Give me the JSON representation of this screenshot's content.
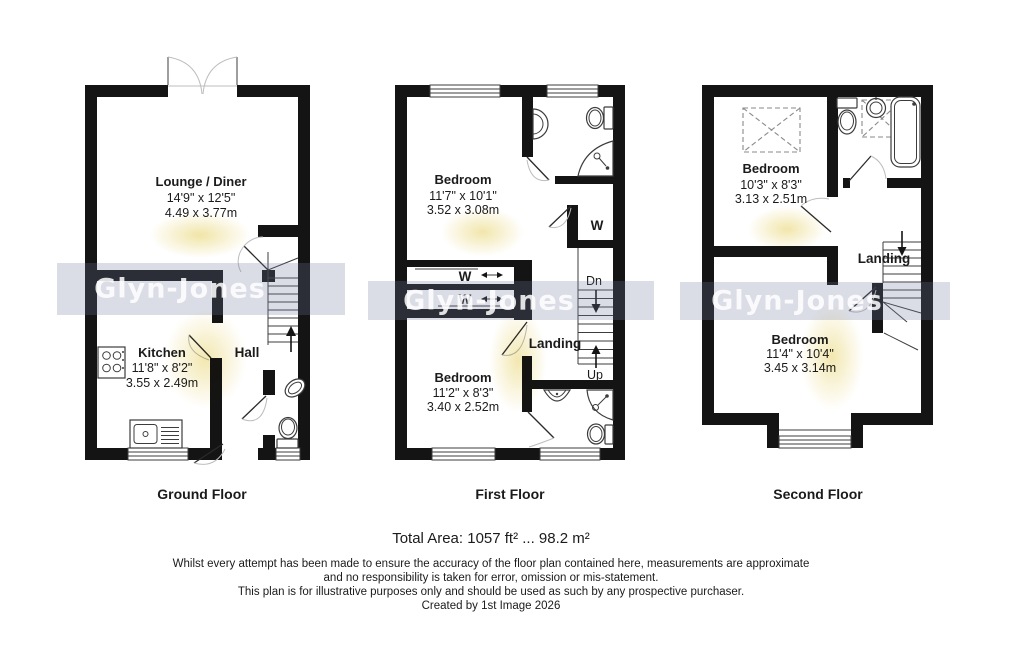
{
  "watermark": {
    "brand": "Glyn-Jones"
  },
  "floors": {
    "ground": {
      "title": "Ground Floor",
      "lounge": {
        "name": "Lounge / Diner",
        "imperial": "14'9\" x 12'5\"",
        "metric": "4.49 x 3.77m"
      },
      "kitchen": {
        "name": "Kitchen",
        "imperial": "11'8\" x 8'2\"",
        "metric": "3.55 x 2.49m"
      },
      "hall": {
        "name": "Hall"
      }
    },
    "first": {
      "title": "First Floor",
      "bedroom_front": {
        "name": "Bedroom",
        "imperial": "11'7\" x 10'1\"",
        "metric": "3.52 x 3.08m"
      },
      "bedroom_back": {
        "name": "Bedroom",
        "imperial": "11'2\" x 8'3\"",
        "metric": "3.40 x 2.52m"
      },
      "landing": {
        "name": "Landing"
      },
      "wardrobe_label": "W",
      "stairs_down_label": "Dn",
      "stairs_up_label": "Up"
    },
    "second": {
      "title": "Second Floor",
      "bedroom_front": {
        "name": "Bedroom",
        "imperial": "10'3\" x 8'3\"",
        "metric": "3.13 x 2.51m"
      },
      "bedroom_back": {
        "name": "Bedroom",
        "imperial": "11'4\" x 10'4\"",
        "metric": "3.45 x 3.14m"
      },
      "landing": {
        "name": "Landing"
      }
    }
  },
  "footer": {
    "total_area": "Total Area: 1057 ft² ... 98.2 m²",
    "disclaimer_line1": "Whilst every attempt has been made to ensure the accuracy of the floor plan contained here, measurements are approximate",
    "disclaimer_line2": "and no responsibility is taken for error, omission or mis-statement.",
    "disclaimer_line3": "This plan is for illustrative purposes only and should be used as such by any prospective purchaser.",
    "created_by": "Created by 1st Image 2026"
  },
  "colors": {
    "wall": "#141414",
    "watermark_band": "#747c9e",
    "watermark_text": "#ffffff",
    "sunflower": "#f0e3a2"
  }
}
